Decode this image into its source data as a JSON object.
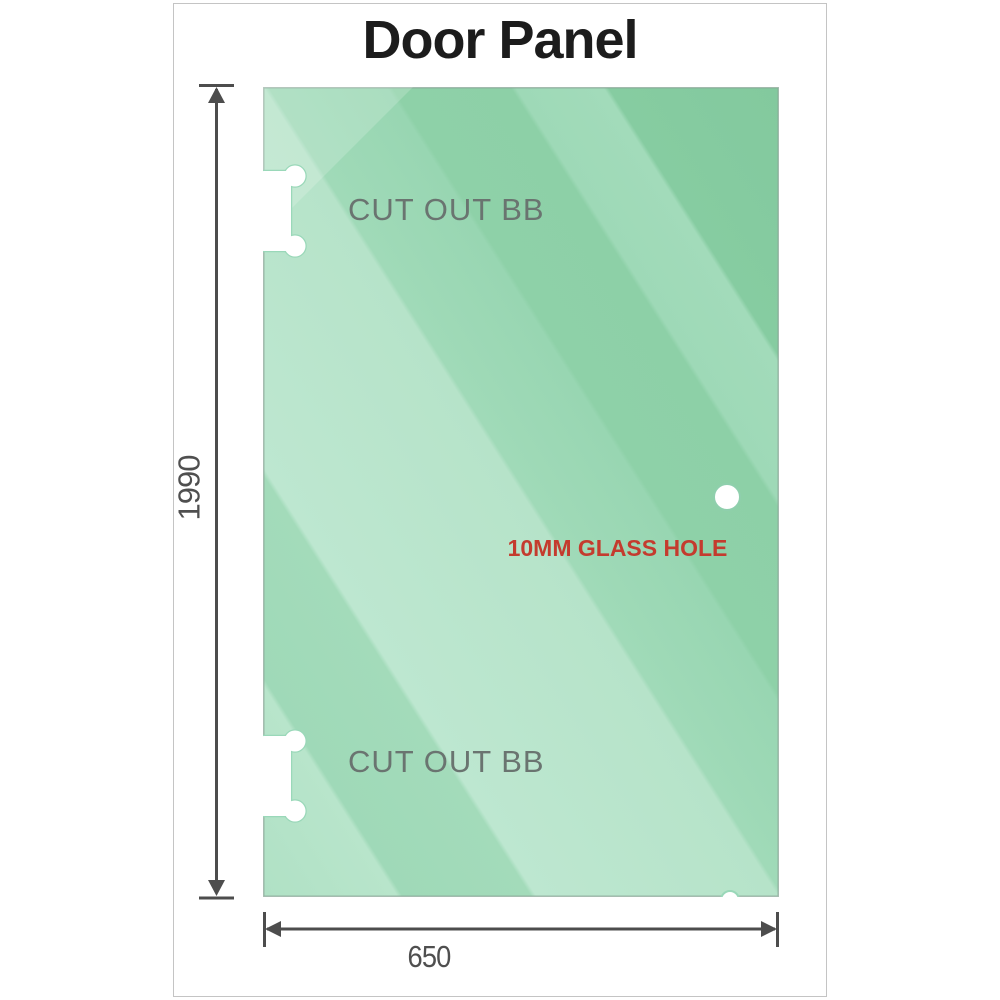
{
  "title": "Door Panel",
  "glass_panel": {
    "cutouts": [
      {
        "label": "CUT OUT BB"
      },
      {
        "label": "CUT OUT BB"
      }
    ],
    "hole": {
      "label": "10MM GLASS HOLE"
    }
  },
  "dimensions": {
    "height_mm": "1990",
    "width_mm": "650"
  },
  "colors": {
    "glass_dark": "#85cba1",
    "glass_medium": "#9ad7b3",
    "glass_light": "#b9e4cb",
    "dimension_gray": "#4d4d4d",
    "dimension_text_gray": "#4f4f4f",
    "cutout_label_gray": "#6a7470",
    "hole_label_red": "#c43b2e",
    "title_color": "#1c1c1c",
    "frame_border": "#c4c4c4"
  }
}
